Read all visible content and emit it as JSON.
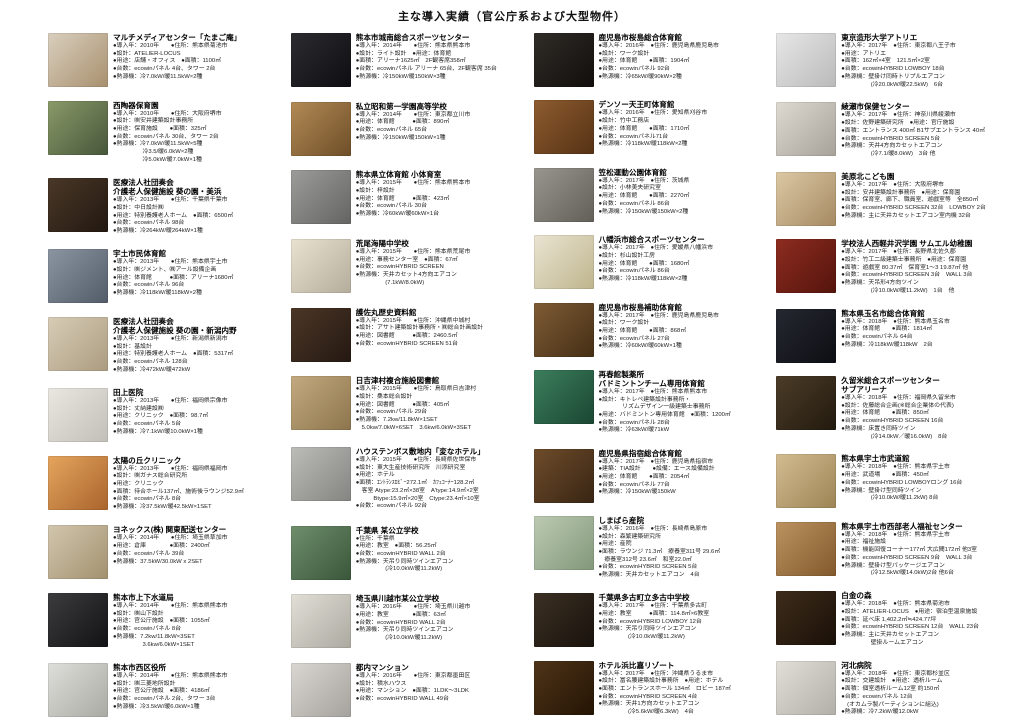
{
  "title": "主な導入実績（官公庁系および大型物件）",
  "columns": [
    {
      "entries": [
        {
          "name": "マルチメディアセンター「たまご庵」",
          "photo_colors": [
            "#d9cfbe",
            "#a8906e"
          ],
          "lines": [
            "●導入年：2010年　　●住所：熊本県菊池市",
            "●設計：ATELIER-LOCUS",
            "●用途：店舗・オフィス　●面積：1100㎡",
            "●台数：ecowinパネル 4台、タワー 2台",
            "●熱源機：冷7.0kW/暖11.5kW×2種"
          ]
        },
        {
          "name": "西陶器保育園",
          "photo_colors": [
            "#8a9a68",
            "#46563a"
          ],
          "lines": [
            "●導入年：2010年　　●住所：大阪府堺市",
            "●設計：㈱安井建築設計事務所",
            "●用途：保育施設　　●面積：325㎡",
            "●台数：ecowinパネル 30台、タワー 2台",
            "●熱源機：冷7.0kW/暖11.5kW×5種",
            "　　　　　冷3.5/暖6.0kW×2種",
            "　　　　　冷5.0kW/暖7.0kW×1種"
          ]
        },
        {
          "name": "医療法人社団奏会\n介護老人保健施設 葵の園・美浜",
          "photo_colors": [
            "#4a3828",
            "#221810"
          ],
          "lines": [
            "●導入年：2013年　　●住所：千葉県千葉市",
            "●設計：中日設計㈱",
            "●用途：特別養護老人ホーム　●面積：6500㎡",
            "●台数：ecowinパネル 98台",
            "●熱源機：冷264kW/暖264kW×1種"
          ]
        },
        {
          "name": "宇土市民体育館",
          "photo_colors": [
            "#8c95a2",
            "#525c68"
          ],
          "lines": [
            "●導入年：2013年　　●住所：熊本県宇土市",
            "●設計：㈱ジメント、㈱アール設備企画",
            "●用途：体育館　　　●面積：アリーナ1680㎡",
            "●台数：ecowinパネル 96台",
            "●熱源機：冷118kW/暖118kW×2種"
          ]
        },
        {
          "name": "医療法人社団奏会\n介護老人保健施設 葵の園・新潟内野",
          "photo_colors": [
            "#d8ccb6",
            "#ab9c80"
          ],
          "lines": [
            "●導入年：2013年　　●住所：新潟県新潟市",
            "●設計：基設計",
            "●用途：特別養護老人ホーム　●面積：5317㎡",
            "●台数：ecowinパネル 128台",
            "●熱源機：冷472kW/暖472kW"
          ]
        },
        {
          "name": "田上医院",
          "photo_colors": [
            "#eae7e1",
            "#c2bfb8"
          ],
          "lines": [
            "●導入年：2013年　　●住所：福岡県宗像市",
            "●設計：丈納建設㈱",
            "●用途：クリニック　●面積：98.7㎡",
            "●台数：ecowinパネル 5台",
            "●熱源機：冷7.1kW/暖10.0kW×1種"
          ]
        },
        {
          "name": "太陽の丘クリニック",
          "photo_colors": [
            "#e5a55e",
            "#a9642c"
          ],
          "lines": [
            "●導入年：2013年　　●住所：福岡県福岡市",
            "●設計：㈱ガナス総合研究所",
            "●用途：クリニック",
            "●面積：待合ホール137㎡、施術後ラウンジ52.9㎡",
            "●台数：ecowinパネル 8台",
            "●熱源機：冷37.5kW/暖42.5kW×1SET"
          ]
        },
        {
          "name": "ヨネックス(株) 関東配送センター",
          "photo_colors": [
            "#d2c6ae",
            "#a2916f"
          ],
          "lines": [
            "●導入年：2014年　　●住所：埼玉県草加市",
            "●用途：倉庫　　　　●面積：2400㎡",
            "●台数：ecowinパネル 39台",
            "●熱源機：37.5kW/30.0kW x 2SET"
          ]
        },
        {
          "name": "熊本市上下水道局",
          "photo_colors": [
            "#3c3c3e",
            "#121214"
          ],
          "lines": [
            "●導入年：2014年　　●住所：熊本県熊本市",
            "●設計：㈱山下設計",
            "●用途：官公庁施設　●面積：1055㎡",
            "●台数：ecowinパネル 8台",
            "●熱源機：7.2kw/11.8kW×3SET",
            "　　　　　3.6kw/6.0kW×1SET"
          ]
        },
        {
          "name": "熊本市西区役所",
          "photo_colors": [
            "#dededa",
            "#aaaaa4"
          ],
          "lines": [
            "●導入年：2014年　　●住所：熊本県熊本市",
            "●設計：㈱三菱地所設計",
            "●用途：官公庁施設　●面積：4186㎡",
            "●台数：ecowinパネル 2台、タワー 3台",
            "●熱源機：冷3.5kW/暖6.0kW×1種"
          ]
        }
      ]
    },
    {
      "entries": [
        {
          "name": "熊本市城南総合スポーツセンター",
          "photo_colors": [
            "#2c2c30",
            "#0e0e12"
          ],
          "lines": [
            "●導入年：2014年　　●住所：熊本県熊本市",
            "●設計：ライト設計　●用途：体育館",
            "●面積：アリーナ1625㎡　2F観客席358㎡",
            "●台数：ecowinパネル アリーナ 65台、2F観客席 35台",
            "●熱源機：冷150kW/暖150kW×3種"
          ]
        },
        {
          "name": "私立昭和第一学園高等学校",
          "photo_colors": [
            "#b28a55",
            "#6e4e28"
          ],
          "lines": [
            "●導入年：2014年　　●住所：東京都立川市",
            "●用途：体育館　　　●面積：890㎡",
            "●台数：ecowinパネル 65台",
            "●熱源機：冷150kW/暖150kW×1種"
          ]
        },
        {
          "name": "熊本県立体育館 小体育室",
          "photo_colors": [
            "#9c9c9a",
            "#646462"
          ],
          "lines": [
            "●導入年：2015年　　●住所：熊本県熊本市",
            "●設計：梓設計",
            "●用途：体育館　　　●面積：423㎡",
            "●台数：ecowinパネル 30台",
            "●熱源機：冷60kW/暖60kW×1台"
          ]
        },
        {
          "name": "荒尾海陽中学校",
          "photo_colors": [
            "#eae2d0",
            "#b5ad9c"
          ],
          "lines": [
            "●導入年：2015年　　●住所：熊本県荒尾市",
            "●用途：事務センター室　●面積：67㎡",
            "●台数：ecowinHYBRID SCREEN",
            "●熱源機：天井カセット4方向エアコン",
            "　　　　　(7.1kW/8.0kW)"
          ]
        },
        {
          "name": "護佐丸歴史資料館",
          "photo_colors": [
            "#4c3726",
            "#241812"
          ],
          "lines": [
            "●導入年：2015年　　●住所：沖縄県中城村",
            "●設計：アサト建築設計事務所・㈱総合計画設計",
            "●用途：図書館　　　●面積：2460.5㎡",
            "●台数：ecowinHYBRID SCREEN 51台"
          ]
        },
        {
          "name": "日吉津村複合施設図書館",
          "photo_colors": [
            "#c3aa80",
            "#8c744c"
          ],
          "lines": [
            "●導入年：2015年　　●住所：鳥取県日吉津村",
            "●設計：桑本総合設計",
            "●用途：図書館　　　●面積：405㎡",
            "●台数：ecowinパネル 29台",
            "●熱源機：7.2kw/11.8kW×1SET",
            "　5.0kw/7.0kW×6SET　3.6kw/6.0kW×3SET"
          ]
        },
        {
          "name": "ハウステンボス敷地内「変なホテル」",
          "photo_colors": [
            "#bcbcb8",
            "#848480"
          ],
          "lines": [
            "●導入年：2015年　　●住所：長崎県佐世保市",
            "●設計：東大生産技術研究所　川添研究室",
            "●用途：ホテル",
            "●面積：ｴﾝﾄﾗﾝｽﾛﾋﾞｰ272.1㎡　ｶﾌｪｺｰﾅｰ128.2㎡",
            "　客室 Atype:23.2㎡×38室　A'type:14.9㎡×2室",
            "　　　Btype:15.9㎡×20室　Ctype:23.4㎡×10室",
            "●台数：ecowinパネル 92台"
          ]
        },
        {
          "name": "千葉県 某公立学校",
          "photo_colors": [
            "#6e8e6c",
            "#3a563a"
          ],
          "lines": [
            "●住所：千葉県",
            "●用途：教室　●面積：56.25㎡",
            "●台数：ecowinHYBRID WALL 2台",
            "●熱源機：天吊り同時ツインエアコン",
            "　　　　　(冷10.0kW/暖11.2kW)"
          ]
        },
        {
          "name": "埼玉県川越市某公立学校",
          "photo_colors": [
            "#e2dfd7",
            "#aca9a1"
          ],
          "lines": [
            "●導入年：2016年　　●住所：埼玉県川越市",
            "●用途：教室　　　　●面積：63㎡",
            "●台数：ecowinHYBRID WALL 2台",
            "●熱源機：天吊り同時ツインエアコン",
            "　　　　　(冷10.0kW/暖11.2kW)"
          ]
        },
        {
          "name": "都内マンション",
          "photo_colors": [
            "#dad7d2",
            "#a5a29d"
          ],
          "lines": [
            "●導入年：2016年　　●住所：東京都墨田区",
            "●設計：積水ハウス",
            "●用途：マンション　●面積：1LDK〜3LDK",
            "●台数：ecowinHYBRID WALL 49台"
          ]
        }
      ]
    },
    {
      "entries": [
        {
          "name": "鹿児島市桜島総合体育館",
          "photo_colors": [
            "#302c28",
            "#110e0b"
          ],
          "lines": [
            "●導入年：2016年　●住所：鹿児島県鹿児島市",
            "●設計：ワーク設計",
            "●用途：体育館　　●面積：1904㎡",
            "●台数：ecowinパネル 92台",
            "●熱源機：冷65kW/暖90kW×2種"
          ]
        },
        {
          "name": "デンソー天王町体育館",
          "photo_colors": [
            "#8e5c30",
            "#553213"
          ],
          "lines": [
            "●導入年：2016年　●住所：愛知県刈谷市",
            "●設計：竹中工務店",
            "●用途：体育館　　●面積：1710㎡",
            "●台数：ecowinパネル71台",
            "●熱源機：冷118kW/暖118kW×2種"
          ]
        },
        {
          "name": "笠松運動公園体育館",
          "photo_colors": [
            "#99958f",
            "#625e58"
          ],
          "lines": [
            "●導入年：2017年　●住所：茨城県",
            "●設計：小林美夫研究室",
            "●用途：体育館　　●面積：2270㎡",
            "●台数：ecowinパネル 86台",
            "●熱源機：冷150kW/暖150kW×2種"
          ]
        },
        {
          "name": "八幡浜市総合スポーツセンター",
          "photo_colors": [
            "#eae4d2",
            "#beb58c"
          ],
          "lines": [
            "●導入年：2017年　●住所：愛媛県八幡浜市",
            "●設計：杉山設計工房",
            "●用途：体育館　　●面積：1680㎡",
            "●台数：ecowinパネル 86台",
            "●熱源機：冷118kW/暖118kW×2種"
          ]
        },
        {
          "name": "鹿児島市桜島補助体育館",
          "photo_colors": [
            "#7e5c35",
            "#452e15"
          ],
          "lines": [
            "●導入年：2017年　●住所：鹿児島県鹿児島市",
            "●設計：ワーク設計",
            "●用途：体育館　　●面積：868㎡",
            "●台数：ecowinパネル 27台",
            "●熱源機：冷60kW/暖60kW×1種"
          ]
        },
        {
          "name": "再春館製薬所\nバドミントンチーム専用体育館",
          "photo_colors": [
            "#3c7e5c",
            "#1a4632"
          ],
          "lines": [
            "●導入年：2017年　●住所：熊本県熊本市",
            "●設計：キトレペ建築設計事務所・",
            "　　　　リズムデザイン一級建築士事務所",
            "●用途：バドミントン専用体育館　●面積：1200㎡",
            "●台数：ecowinパネル 28台",
            "●熱源機：冷63kW/暖71kW"
          ]
        },
        {
          "name": "鹿児島県指宿総合体育館",
          "photo_colors": [
            "#6e4c2a",
            "#382513"
          ],
          "lines": [
            "●導入年：2017年　●住所：鹿児島県指宿市",
            "●建築：TIA設計　　●設備：エース設備設計",
            "●用途：体育館　　●面積：2054㎡",
            "●台数：ecowinパネル 77台",
            "●熱源機：冷150kW/暖150kW"
          ]
        },
        {
          "name": "しまばら産院",
          "photo_colors": [
            "#bccab2",
            "#82987a"
          ],
          "lines": [
            "●導入年：2016年　●住所：長崎県島原市",
            "●設計：森繁建築研究所",
            "●用途：産院",
            "●面積：ラウンジ 71.3㎡　療養室311号 29.6㎡",
            "　療養室312号 23.6㎡　和室22.0㎡",
            "●台数：ecowinHYBRID SCREEN 5台",
            "●熱源機：天井カセットエアコン　4台"
          ]
        },
        {
          "name": "千葉県多古町立多古中学校",
          "photo_colors": [
            "#3c3024",
            "#18120c"
          ],
          "lines": [
            "●導入年：2017年　●住所：千葉県多古町",
            "●用途：教室　　　●面積：114.8㎡×6教室",
            "●台数：ecowinHYBRID LOWBOY 12台",
            "●熱源機：天吊り同時ツインエアコン",
            "　　　　　(冷10.0kW/暖11.2kW)"
          ]
        },
        {
          "name": "ホテル浜比嘉リゾート",
          "photo_colors": [
            "#4e3418",
            "#241404"
          ],
          "lines": [
            "●導入年：2017年　●住所：沖縄県うるま市",
            "●設計：冨名腰建築設計事務所　●用途：ホテル",
            "●面積：エントランスホール 134㎡　ロビー 187㎡",
            "●台数：ecowinHYBRID SCREEN 4台",
            "●熱源機：天井1方向カセットエアコン",
            "　　　　　(冷5.6kW/暖6.3kW)　4台"
          ]
        }
      ]
    },
    {
      "entries": [
        {
          "name": "東京造形大学アトリエ",
          "photo_colors": [
            "#e7e7e7",
            "#bababa"
          ],
          "lines": [
            "●導入年：2017年　●住所：東京都八王子市",
            "●用途：アトリエ",
            "●面積：162㎡×4室　121.5㎡×2室",
            "●台数：ecowinHYBRID LOWBOY 18台",
            "●熱源機：壁掛け同時トリプルエアコン",
            "　　　　　(冷20.0kW/暖22.5kW)　6台"
          ]
        },
        {
          "name": "綾瀬市保健センター",
          "photo_colors": [
            "#dfdad1",
            "#a7a299"
          ],
          "lines": [
            "●導入年：2017年　●住所：神奈川県綾瀬市",
            "●設計：佐野建築研究所　●用途：官庁施設",
            "●面積：エントランス 400㎡ B1サブエントランス 40㎡",
            "●台数：ecowinHYBRID SCREEN 5台",
            "●熱源機：天井4方向カセットエアコン",
            "　　　　　(冷7.1/暖8.0kW)　3台 他"
          ]
        },
        {
          "name": "美原北こども園",
          "photo_colors": [
            "#dcc8a4",
            "#a58a62"
          ],
          "lines": [
            "●導入年：2017年　●住所：大阪府堺市",
            "●設計：安井建築設計事務所　●用途：保育園",
            "●面積：保育室、廊下、職員室、遊戯室等　全850㎡",
            "●台数：ecowinHYBRID SCREEN 32台　LOWBOY 2台",
            "●熱源機：主に天井カセットエアコン室内機 32台"
          ]
        },
        {
          "name": "学校法人西軽井沢学園 サムエル幼稚園",
          "photo_colors": [
            "#8e2c20",
            "#54140c"
          ],
          "lines": [
            "●導入年：2017年　●住所：長野県北佐久郡",
            "●設計：竹工二級建築士事務所　●用途：保育園",
            "●面積：遊戯室 80.37㎡　保育室1〜3 19.87㎡ 他",
            "●台数：ecowinHYBRID SCREEN 3台　WALL 3台",
            "●熱源機：天吊形4方向ツイン",
            "　　　　　(冷10.0kW/暖11.2kW)　1台　他"
          ]
        },
        {
          "name": "熊本県玉名市総合体育館",
          "photo_colors": [
            "#252830",
            "#0c0e13"
          ],
          "lines": [
            "●導入年：2018年　●住所：熊本県玉名市",
            "●用途：体育館　　●面積：1814㎡",
            "●台数：ecowinパネル 64台",
            "●熱源機：冷118kW/暖118kW　2台"
          ]
        },
        {
          "name": "久留米総合スポーツセンター\nサブアリーナ",
          "photo_colors": [
            "#4c3c28",
            "#221a0e"
          ],
          "lines": [
            "●導入年：2018年　●住所：福岡県久留米市",
            "●設計：佐藤総合企画(※総合企業体の代表)",
            "●用途：体育館　　●面積：850㎡",
            "●台数：ecowinHYBRID SCREEN 16台",
            "●熱源機：床置き同時ツイン",
            "　　　　　(冷14.0kW／暖16.0kW)　8台"
          ]
        },
        {
          "name": "熊本県宇土市武道館",
          "photo_colors": [
            "#d4bc92",
            "#9c8455"
          ],
          "lines": [
            "●導入年：2018年　●住所：熊本県宇土市",
            "●用途：武道場　　●面積：450㎡",
            "●台数：ecowinHYBRID LOWBOYロング 16台",
            "●熱源機：壁掛け型同時ツイン",
            "　　　　　(冷10.0kW/暖11.2kW) 8台"
          ]
        },
        {
          "name": "熊本県宇土市西部老人福祉センター",
          "photo_colors": [
            "#bb9260",
            "#82592c"
          ],
          "lines": [
            "●導入年：2018年　●住所：熊本県宇土市",
            "●用途：福祉施設",
            "●面積：機能回復コーナー177㎡ 大広間172㎡ 他3室",
            "●台数：ecowinHYBRID SCREEN 9台　WALL 3台",
            "●熱源機：壁掛け型パッケージエアコン",
            "　　　　　(冷12.5kW/暖14.0kW)2台 他6台"
          ]
        },
        {
          "name": "白金の森",
          "photo_colors": [
            "#3e2c1a",
            "#1a1008"
          ],
          "lines": [
            "●導入年：2018年　●住所：熊本県菊池市",
            "●設計：ATELIER-LOCUS　●用途：宿泊型温泉施設",
            "●面積：延べ床 1,402.2㎡≒424.77坪",
            "●台数：ecowinHYBRID SCREEN 12台　WALL 23台",
            "●熱源機：主に天井カセットエアコン",
            "　　　　　壁掛ルームエアコン"
          ]
        },
        {
          "name": "河北病院",
          "photo_colors": [
            "#e2dedา8",
            "#b2aea8"
          ],
          "lines": [
            "●導入年：2018年　●住所：東京都杉並区",
            "●設計：交建設計　●用途：透析ルーム",
            "●面積：個室透析ルーム12室 約150㎡",
            "●台数：ecowinパネル 12台",
            "　(オカムラ製パーティションに組込)",
            "●熱源機：冷7.2kW/暖12.0kW"
          ]
        }
      ]
    }
  ]
}
